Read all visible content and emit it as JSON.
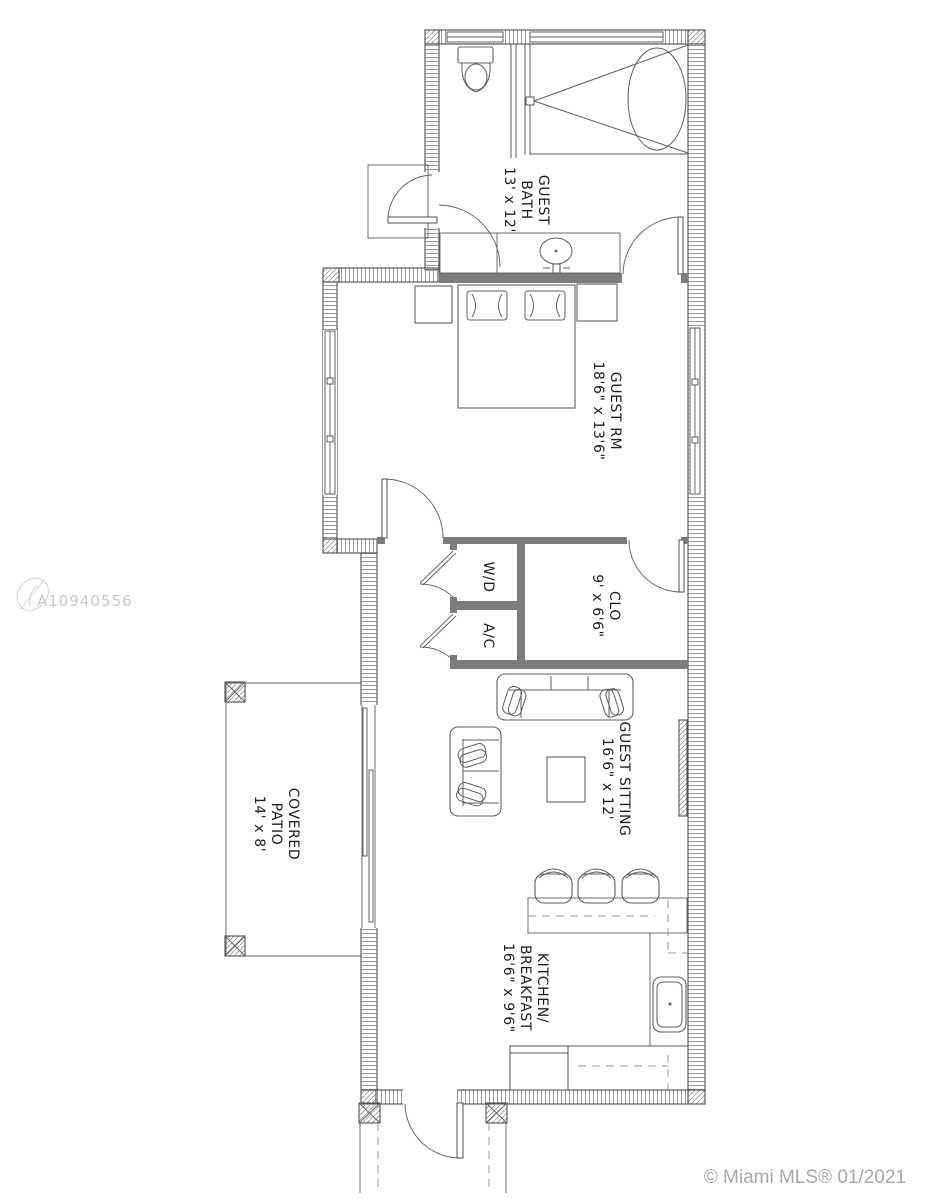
{
  "plan": {
    "rooms": [
      {
        "name": "guest-bath",
        "lines": [
          "GUEST",
          "BATH",
          "13' x 12'"
        ]
      },
      {
        "name": "guest-room",
        "lines": [
          "GUEST RM",
          "18'6\" x 13'6\""
        ]
      },
      {
        "name": "closet",
        "lines": [
          "CLO",
          "9' x 6'6\""
        ]
      },
      {
        "name": "washer-dryer",
        "lines": [
          "W/D"
        ]
      },
      {
        "name": "ac-closet",
        "lines": [
          "A/C"
        ]
      },
      {
        "name": "guest-sitting",
        "lines": [
          "GUEST SITTING",
          "16'6\" x 12'"
        ]
      },
      {
        "name": "covered-patio",
        "lines": [
          "COVERED",
          "PATIO",
          "14' x 8'"
        ]
      },
      {
        "name": "kitchen-breakfast",
        "lines": [
          "KITCHEN/",
          "BREAKFAST",
          "16'6\" x 9'6\""
        ]
      }
    ],
    "watermark": "A10940556",
    "credit": "© Miami MLS® 01/2021"
  },
  "colors": {
    "bg": "#ffffff",
    "line": "#4f4f4f",
    "furn": "#5f5f5f",
    "hatch": "#919191",
    "iwall": "#7c7c7c",
    "dash": "#9a9a9a",
    "text": "#1e1e1e",
    "watermark": "#c9c9c9",
    "credit": "#a4a8ab"
  }
}
